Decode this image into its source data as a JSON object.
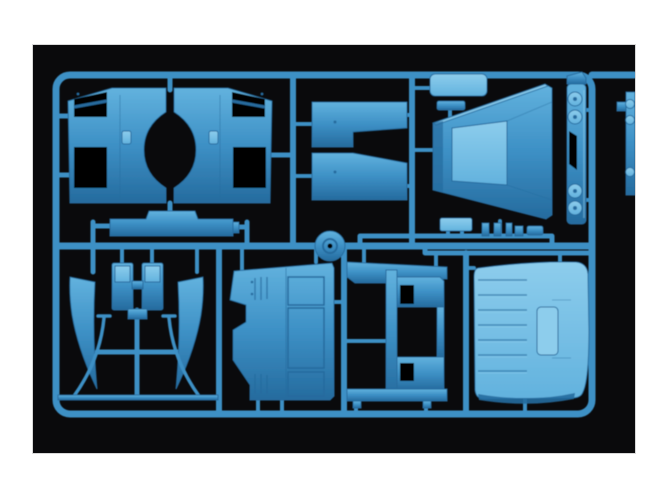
{
  "image": {
    "type": "photograph",
    "description": "Injection-moulded model kit sprue of light-blue plastic truck-cab parts photographed on a black background, framed by white paper border",
    "visible_text": ""
  },
  "colors": {
    "paper": "#ffffff",
    "photo-bg": "#0a0a0c",
    "plastic-base": "#3d90c5",
    "plastic-light": "#62b2de",
    "plastic-lighter": "#8dcdec",
    "plastic-dark": "#256b9e",
    "plastic-deep": "#16415f",
    "hole-black": "#050506"
  },
  "sprue": {
    "material": "blue styrene",
    "runner_shape": "rounded rectangular runner frame with internal runners and a round gate hub",
    "parts": [
      {
        "name": "cab-side-panels",
        "description": "large twin side-wall panel with central oval cut-out and window openings"
      },
      {
        "name": "bumper-bar",
        "description": "long bar with raised centre step"
      },
      {
        "name": "step-slab-upper",
        "description": "stepped slab"
      },
      {
        "name": "step-slab-lower",
        "description": "stepped slab, mirrored"
      },
      {
        "name": "small-plate",
        "description": "small rounded rectangular plate"
      },
      {
        "name": "hood-shell",
        "description": "tapered hood / cowl shell seen in perspective"
      },
      {
        "name": "headlight-bar",
        "description": "vertical strip with four round lamp housings and dark central slot"
      },
      {
        "name": "wind-deflector-left",
        "description": "curved tapering blade"
      },
      {
        "name": "wind-deflector-right",
        "description": "curved tapering blade, mirrored"
      },
      {
        "name": "seat-back-left",
        "description": "small rectangular slab with recessed top"
      },
      {
        "name": "seat-back-right",
        "description": "small rectangular slab with recessed top"
      },
      {
        "name": "support-rod-left",
        "description": "thin curved rod"
      },
      {
        "name": "support-rod-right",
        "description": "thin curved rod"
      },
      {
        "name": "trim-strip",
        "description": "long thin strip"
      },
      {
        "name": "floor-panel",
        "description": "contoured panel with grooved rectangular insets and rib details"
      },
      {
        "name": "rear-frame",
        "description": "frame part with rectangular openings"
      },
      {
        "name": "roof-panel",
        "description": "large ribbed roof panel with raised hatch"
      },
      {
        "name": "edge-part",
        "description": "partially visible strip at right photo edge"
      },
      {
        "name": "small-fittings",
        "description": "row of tiny fittings attached to the runner"
      },
      {
        "name": "gate-hub",
        "description": "round sprue gate hub on centre runner"
      }
    ]
  }
}
